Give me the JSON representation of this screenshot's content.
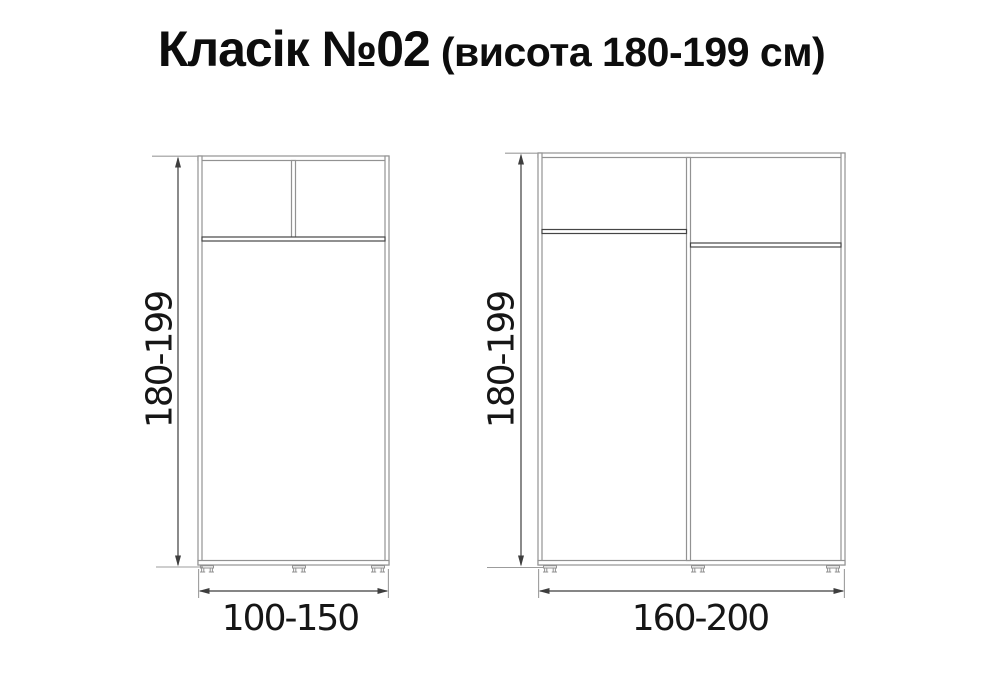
{
  "title": {
    "main": "Класік №02",
    "sub": "(висота 180-199 см)"
  },
  "wardrobes": [
    {
      "height_label": "180-199",
      "width_label": "100-150"
    },
    {
      "height_label": "180-199",
      "width_label": "160-200"
    }
  ],
  "colors": {
    "background": "#ffffff",
    "text": "#161616",
    "title_text": "#0d0d0d",
    "panel_line": "#929292",
    "shelf_line": "#454545",
    "ext_line": "#9c9c9c",
    "dim_line": "#3e3e3e"
  }
}
